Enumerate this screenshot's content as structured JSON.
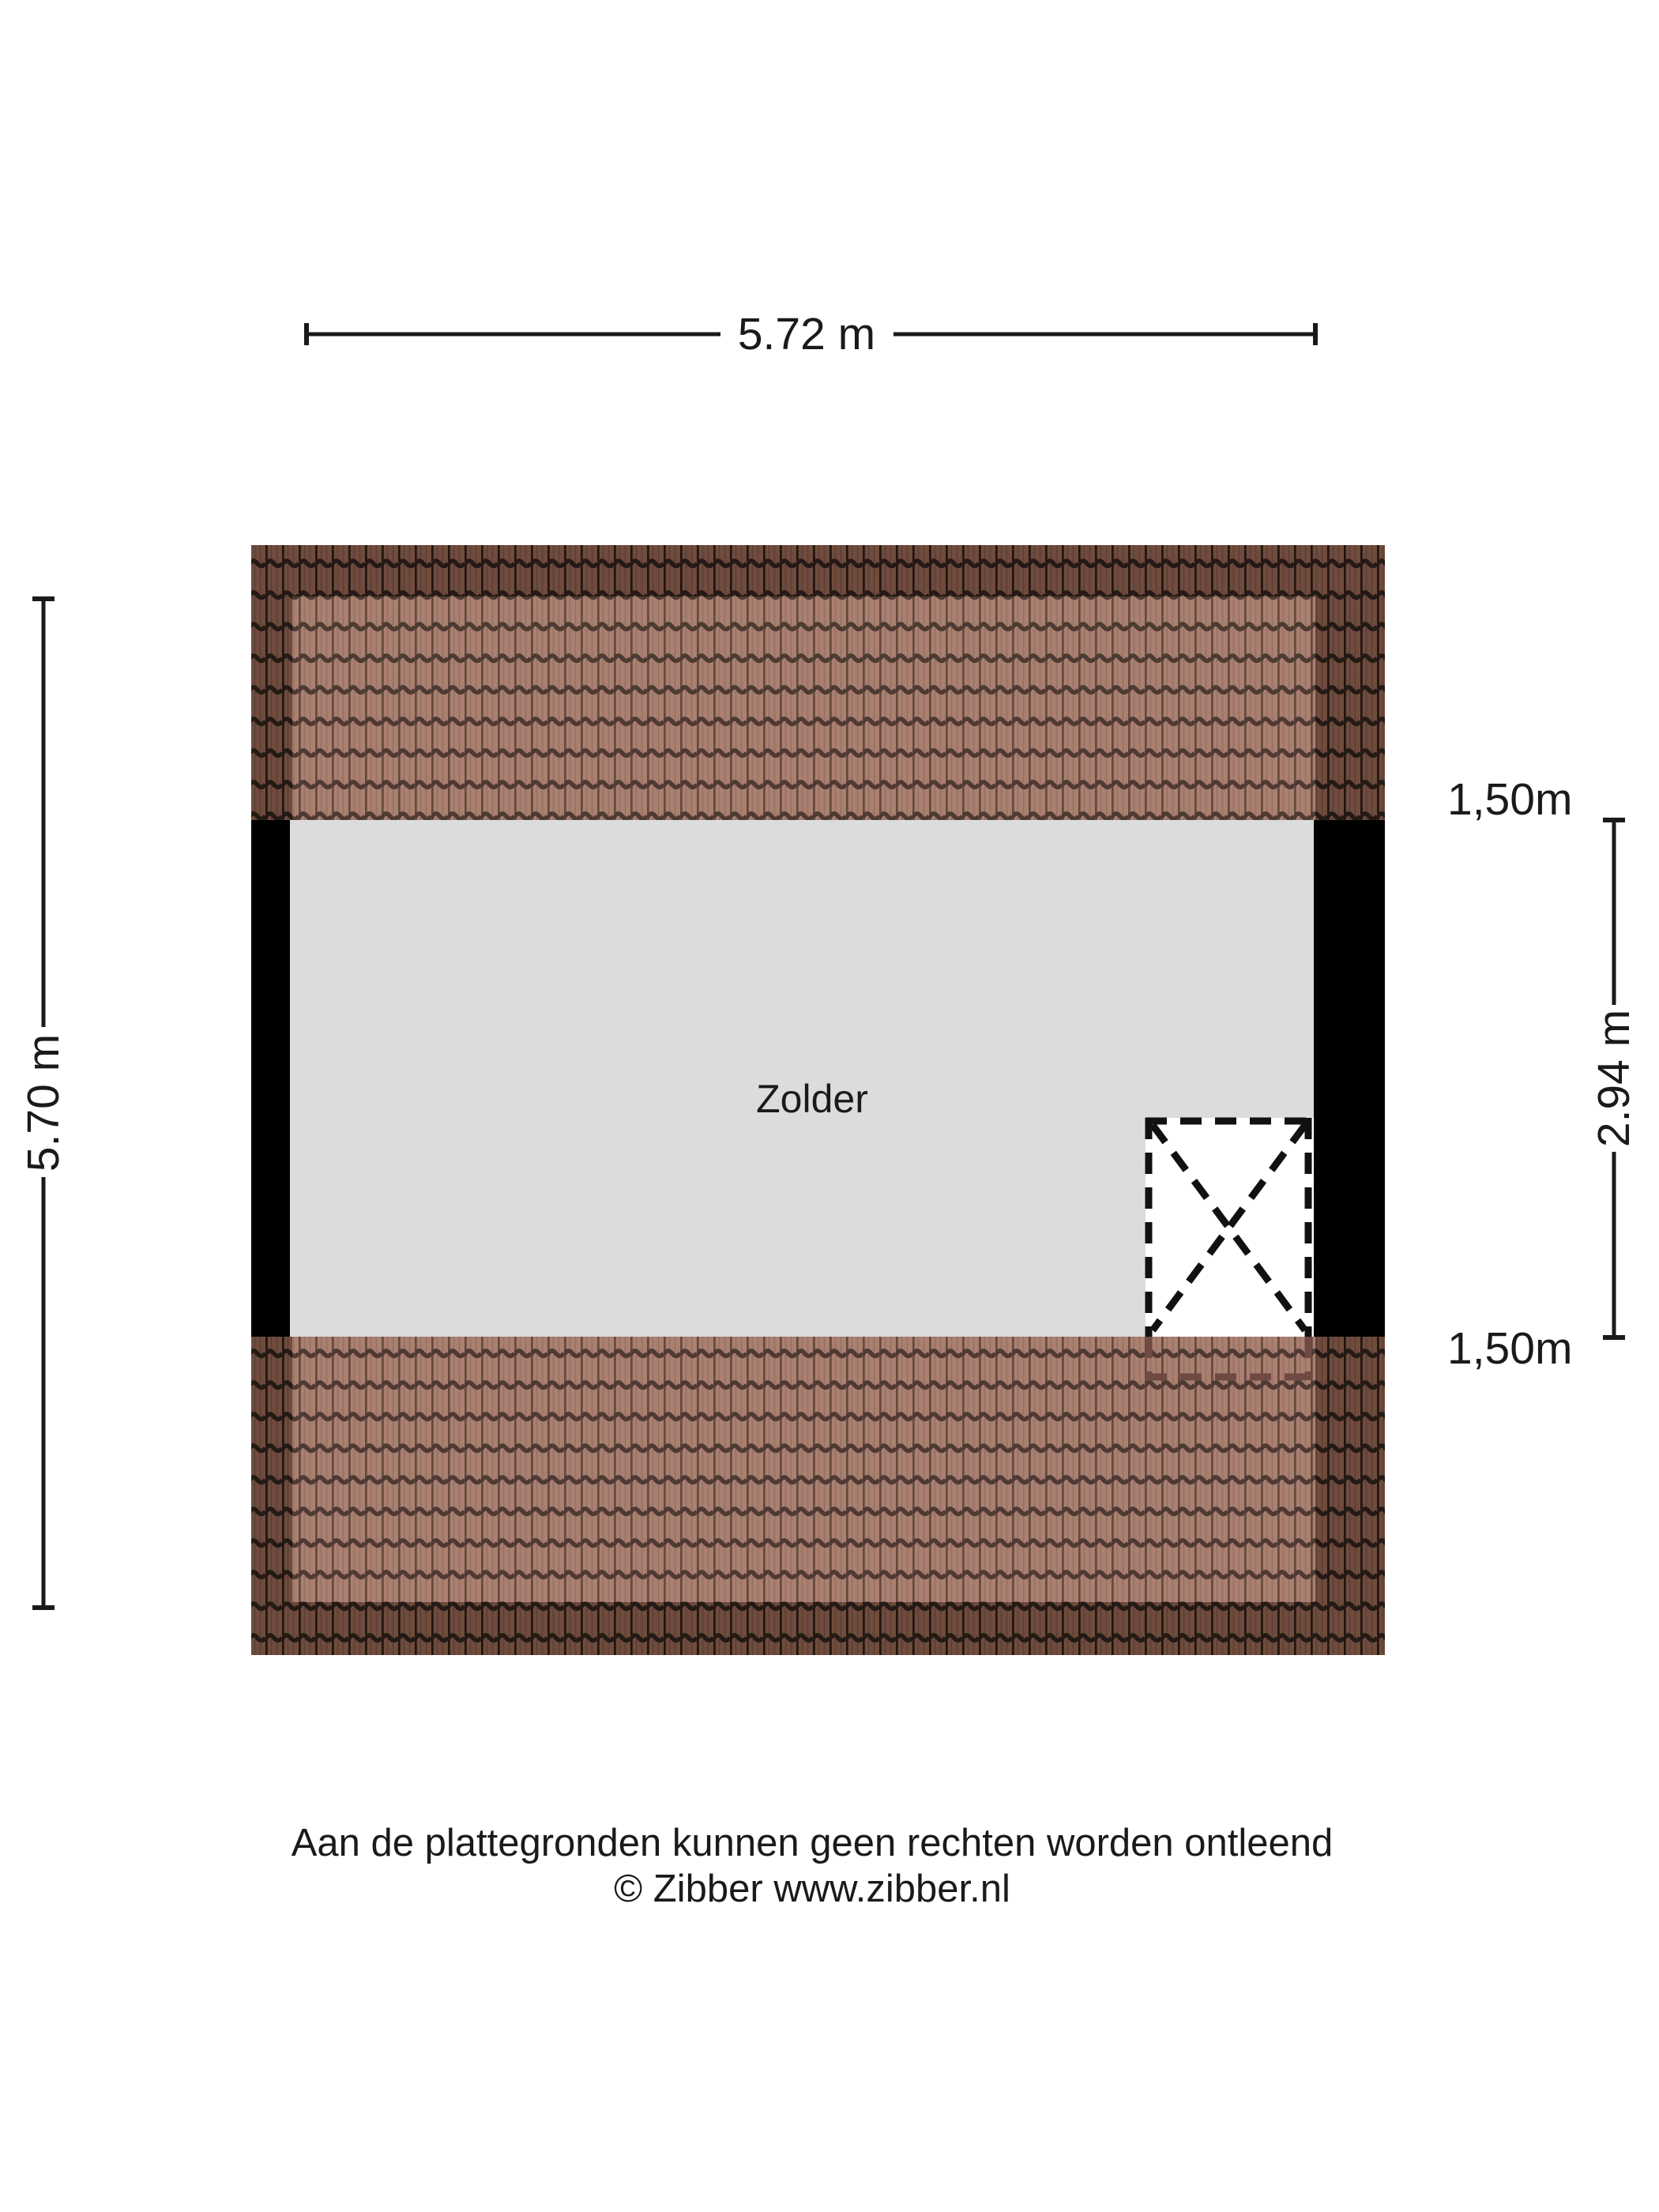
{
  "plan": {
    "room_label": "Zolder",
    "dim_top_label": "5.72 m",
    "dim_left_label": "5.70 m",
    "dim_right_label": "2.94 m",
    "headroom_top_label": "1,50m",
    "headroom_bottom_label": "1,50m"
  },
  "footer": {
    "line1": "Aan de plattegronden kunnen geen rechten worden ontleend",
    "line2": "© Zibber www.zibber.nl"
  },
  "colors": {
    "page_bg": "#ffffff",
    "room_fill": "#dcdcdc",
    "wall": "#000000",
    "tile_dark": "#6f4c3e",
    "tile_dark_line": "#241a15",
    "tile_light": "#aa8071",
    "tile_light_line": "#4e3a33",
    "stair_fill": "#ffffff",
    "dash_black": "#111111",
    "dash_faded": "#6e4a42",
    "dim_line": "#1a1a1a",
    "text": "#1a1a1a"
  }
}
